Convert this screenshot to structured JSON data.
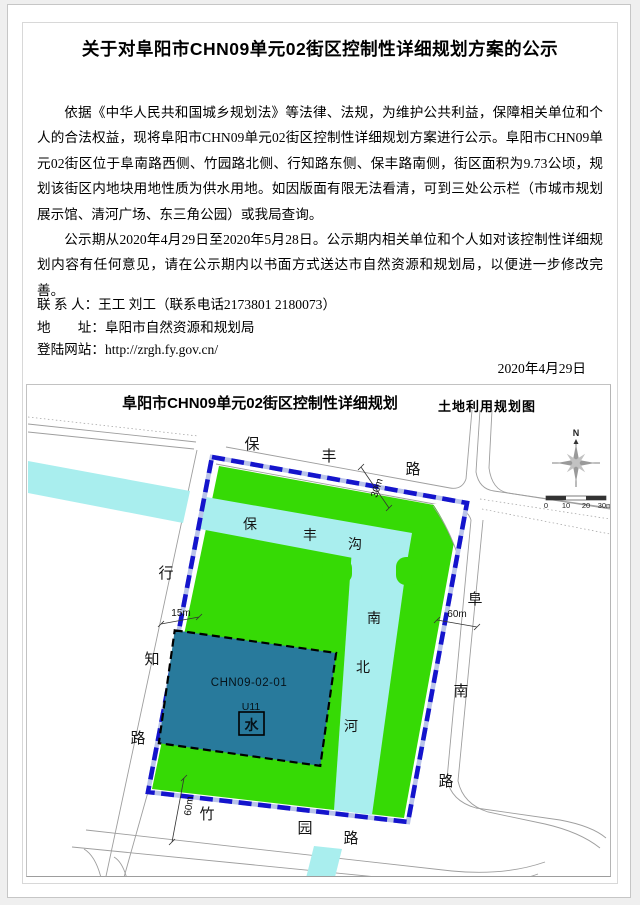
{
  "doc": {
    "title": "关于对阜阳市CHN09单元02街区控制性详细规划方案的公示",
    "p1": "依据《中华人民共和国城乡规划法》等法律、法规，为维护公共利益，保障相关单位和个人的合法权益，现将阜阳市CHN09单元02街区控制性详细规划方案进行公示。阜阳市CHN09单元02街区位于阜南路西侧、竹园路北侧、行知路东侧、保丰路南侧，街区面积为9.73公顷，规划该街区内地块用地性质为供水用地。如因版面有限无法看清，可到三处公示栏（市城市规划展示馆、清河广场、东三角公园）或我局查询。",
    "p2": "公示期从2020年4月29日至2020年5月28日。公示期内相关单位和个人如对该控制性详细规划内容有任何意见，请在公示期内以书面方式送达市自然资源和规划局，以便进一步修改完善。",
    "contact_person": "联 系 人：王工 刘工（联系电话2173801 2180073）",
    "contact_address": "地　　址：阜阳市自然资源和规划局",
    "contact_website": "登陆网站：http://zrgh.fy.gov.cn/",
    "date": "2020年4月29日"
  },
  "map": {
    "title": "阜阳市CHN09单元02街区控制性详细规划",
    "subtitle": "土地利用规划图",
    "compass_n": "N",
    "scale": {
      "labels": [
        "0",
        "10",
        "20",
        "30m"
      ]
    },
    "block": {
      "code": "CHN09-02-01",
      "use_code": "U11",
      "symbol": "水"
    },
    "roads": {
      "baofeng_lu": {
        "chars": [
          "保",
          "丰",
          "路"
        ]
      },
      "xingzhi_lu": {
        "chars": [
          "行",
          "知",
          "路"
        ]
      },
      "zhuyuan_lu": {
        "chars": [
          "竹",
          "园",
          "路"
        ]
      },
      "funan_lu": {
        "chars": [
          "阜",
          "南",
          "路"
        ]
      },
      "baofeng_gou": {
        "chars": [
          "保",
          "丰",
          "沟"
        ]
      },
      "nanbei_he": {
        "chars": [
          "南",
          "北",
          "河"
        ]
      }
    },
    "dims": {
      "xingzhi_width": "15m",
      "baofeng_width": "30m",
      "funan_width": "60m",
      "zhuyuan_width": "60m"
    }
  },
  "colors": {
    "boundary_blue": "#1414cc",
    "boundary_gap": "#b9c3ea",
    "green": "#36da05",
    "water_cyan": "#a9eeee",
    "block_teal": "#287a9c"
  }
}
